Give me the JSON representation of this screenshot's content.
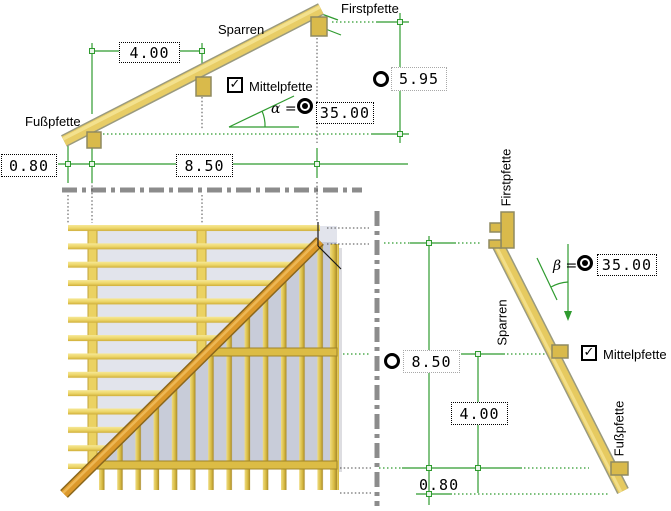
{
  "front_view": {
    "labels": {
      "firstpfette": "Firstpfette",
      "sparren": "Sparren",
      "fusspfette": "Fußpfette"
    },
    "mittelpfette": {
      "label": "Mittelpfette",
      "checked": true,
      "check_glyph": "✓"
    },
    "angle": {
      "symbol": "α =",
      "value": "35.00",
      "selected": true
    },
    "ridge_height": {
      "value": "5.95",
      "selected": false
    },
    "overhang": "0.80",
    "purlin_distance": "4.00",
    "span": "8.50"
  },
  "side_view": {
    "labels": {
      "firstpfette": "Firstpfette",
      "sparren": "Sparren",
      "fusspfette": "Fußpfette"
    },
    "mittelpfette": {
      "label": "Mittelpfette",
      "checked": true,
      "check_glyph": "✓"
    },
    "angle": {
      "symbol": "β =",
      "value": "35.00",
      "selected": true
    },
    "span": {
      "value": "8.50",
      "selected": false
    },
    "purlin_distance": "4.00",
    "overhang": "0.80"
  },
  "colors": {
    "dimension_green": "#2f9b2f",
    "beam_tan": "#e8cd66",
    "purlin_gold": "#d9ba4b",
    "hip_orange": "#dc992b",
    "roof_light": "#e2e4ec",
    "roof_dark": "#c8ccd9",
    "axis_gray": "#8c8c8c"
  }
}
